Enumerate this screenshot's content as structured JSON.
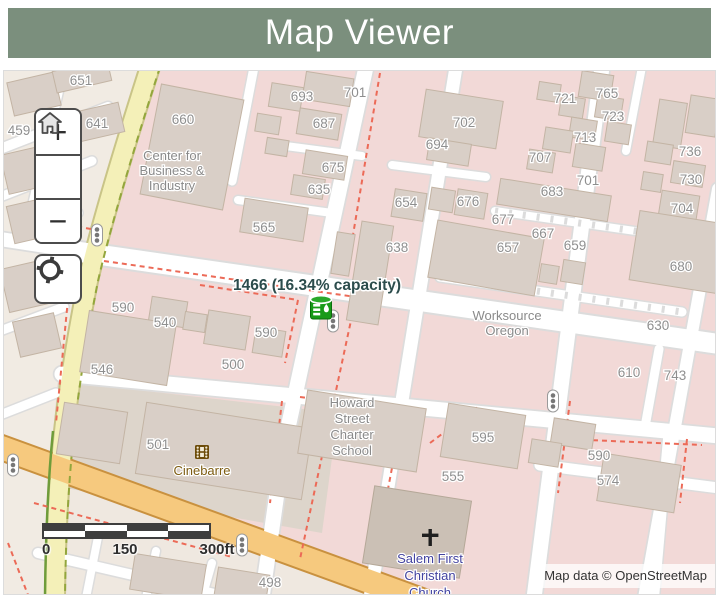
{
  "header": {
    "title": "Map Viewer"
  },
  "controls": {
    "zoom_in": "+",
    "zoom_out": "−",
    "home_icon": "home-icon",
    "locate_icon": "locate-icon"
  },
  "marker": {
    "label": "1466 (16.34% capacity)",
    "icon": "water-tank-icon",
    "color": "#189a18"
  },
  "map": {
    "building_numbers": [
      {
        "text": "651",
        "x": 77,
        "y": 14
      },
      {
        "text": "693",
        "x": 298,
        "y": 30
      },
      {
        "text": "701",
        "x": 351,
        "y": 26
      },
      {
        "text": "687",
        "x": 320,
        "y": 57
      },
      {
        "text": "660",
        "x": 179,
        "y": 53
      },
      {
        "text": "459",
        "x": 15,
        "y": 64
      },
      {
        "text": "641",
        "x": 93,
        "y": 57
      },
      {
        "text": "702",
        "x": 460,
        "y": 56
      },
      {
        "text": "694",
        "x": 433,
        "y": 78
      },
      {
        "text": "721",
        "x": 561,
        "y": 32
      },
      {
        "text": "765",
        "x": 603,
        "y": 27
      },
      {
        "text": "723",
        "x": 609,
        "y": 50
      },
      {
        "text": "713",
        "x": 581,
        "y": 71
      },
      {
        "text": "707",
        "x": 536,
        "y": 91
      },
      {
        "text": "701",
        "x": 584,
        "y": 114
      },
      {
        "text": "683",
        "x": 548,
        "y": 125
      },
      {
        "text": "736",
        "x": 686,
        "y": 85
      },
      {
        "text": "730",
        "x": 687,
        "y": 113
      },
      {
        "text": "704",
        "x": 678,
        "y": 142
      },
      {
        "text": "565",
        "x": 260,
        "y": 161
      },
      {
        "text": "675",
        "x": 329,
        "y": 101
      },
      {
        "text": "635",
        "x": 315,
        "y": 123
      },
      {
        "text": "654",
        "x": 402,
        "y": 136
      },
      {
        "text": "676",
        "x": 464,
        "y": 135
      },
      {
        "text": "638",
        "x": 393,
        "y": 181
      },
      {
        "text": "677",
        "x": 499,
        "y": 153
      },
      {
        "text": "667",
        "x": 539,
        "y": 167
      },
      {
        "text": "657",
        "x": 504,
        "y": 181
      },
      {
        "text": "659",
        "x": 571,
        "y": 179
      },
      {
        "text": "680",
        "x": 677,
        "y": 200
      },
      {
        "text": "590",
        "x": 119,
        "y": 241
      },
      {
        "text": "540",
        "x": 161,
        "y": 256
      },
      {
        "text": "590",
        "x": 262,
        "y": 266
      },
      {
        "text": "546",
        "x": 98,
        "y": 303
      },
      {
        "text": "500",
        "x": 229,
        "y": 298
      },
      {
        "text": "630",
        "x": 654,
        "y": 259
      },
      {
        "text": "610",
        "x": 625,
        "y": 306
      },
      {
        "text": "743",
        "x": 671,
        "y": 309
      },
      {
        "text": "501",
        "x": 154,
        "y": 378
      },
      {
        "text": "595",
        "x": 479,
        "y": 371
      },
      {
        "text": "555",
        "x": 449,
        "y": 410
      },
      {
        "text": "590",
        "x": 595,
        "y": 389
      },
      {
        "text": "574",
        "x": 604,
        "y": 414
      },
      {
        "text": "498",
        "x": 266,
        "y": 516
      }
    ],
    "places": [
      {
        "name": "center-for-business-industry",
        "lines": [
          "Center for",
          "Business &",
          "Industry"
        ],
        "x": 168,
        "ys": [
          89,
          104,
          119
        ],
        "color": "#8a8a8a"
      },
      {
        "name": "worksource-oregon",
        "lines": [
          "Worksource",
          "Oregon"
        ],
        "x": 503,
        "ys": [
          249,
          264
        ],
        "color": "#8a8a8a"
      },
      {
        "name": "howard-street-charter-school",
        "lines": [
          "Howard",
          "Street",
          "Charter",
          "School"
        ],
        "x": 348,
        "ys": [
          336,
          352,
          368,
          384
        ],
        "color": "#8a8a8a"
      },
      {
        "name": "cinebarre",
        "lines": [
          "Cinebarre"
        ],
        "x": 198,
        "ys": [
          404
        ],
        "color": "#7d5c11"
      },
      {
        "name": "salem-first-christian-church",
        "lines": [
          "Salem First",
          "Christian",
          "Church"
        ],
        "x": 426,
        "ys": [
          492,
          509,
          526
        ],
        "color": "#4343a0"
      }
    ]
  },
  "scale_bar": {
    "ticks": [
      "0",
      "150",
      "300ft"
    ]
  },
  "attribution": {
    "text": "Map data © OpenStreetMap"
  }
}
